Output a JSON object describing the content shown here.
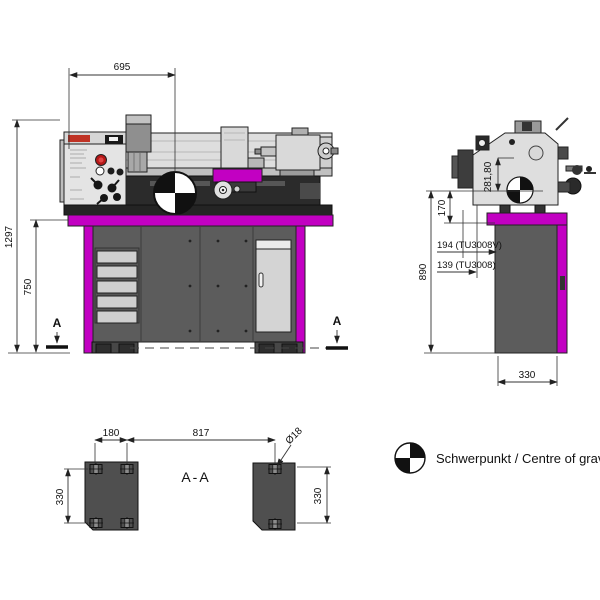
{
  "colors": {
    "magenta": "#c200c2",
    "stand_gray": "#5c5c5c",
    "machine_gray": "#dedede",
    "plate_gray": "#4f4f4f",
    "line": "#222222"
  },
  "front_view": {
    "dim_width": "695",
    "dim_height_total": "1297",
    "dim_height_table": "750",
    "section_marker_left": "A",
    "section_marker_right": "A"
  },
  "side_view": {
    "dim_cog_height": "281,80",
    "dim_cog_to_table": "170",
    "dim_tu3008v": "194 (TU3008V)",
    "dim_tu3008": "139 (TU3008)",
    "dim_cog_floor": "890",
    "dim_depth": "330"
  },
  "section_view": {
    "label": "A-A",
    "dim_hole_spacing": "180",
    "dim_feet_distance": "817",
    "dim_depth_left": "330",
    "dim_depth_right": "330",
    "dim_hole_diameter": "Ø18"
  },
  "legend": {
    "cog_label": "Schwerpunkt / Centre of gravity"
  }
}
